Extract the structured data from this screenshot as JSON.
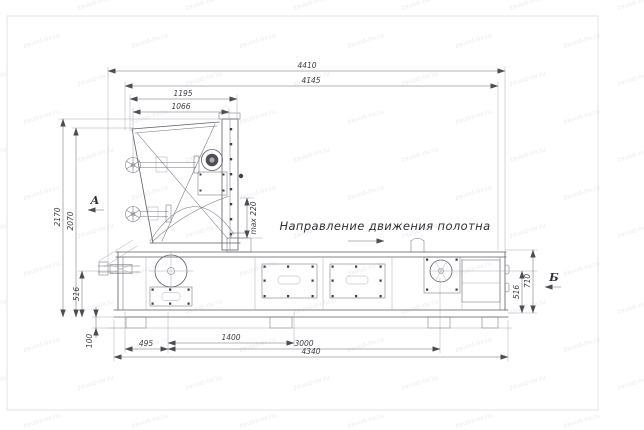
{
  "watermark": {
    "text": "zavod-nv.ru"
  },
  "drawing": {
    "dimensions": {
      "top": {
        "overall": "4410",
        "frame": "4145",
        "hopper": "1195",
        "inner": "1066"
      },
      "left": {
        "overall": "2170",
        "inner": "2070",
        "lower": "516",
        "feet": "100"
      },
      "bottom": {
        "left_offset": "495",
        "mid": "1400",
        "long": "3000",
        "base": "4340"
      },
      "right": {
        "lower": "516",
        "upper": "710"
      },
      "max_gap": "max 220"
    },
    "annotations": {
      "direction_label": "Направление движения полотна",
      "section_a": "А",
      "section_b": "Б"
    }
  }
}
